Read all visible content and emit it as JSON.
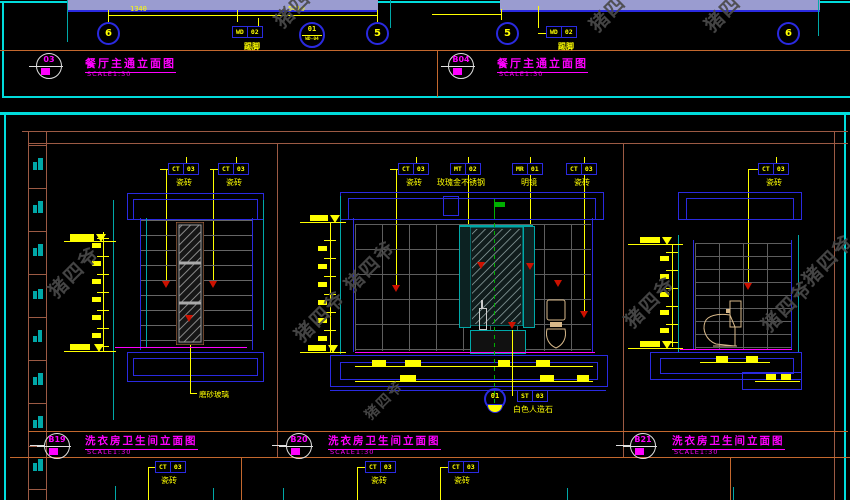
{
  "watermark": "猪四爷",
  "colors": {
    "background": "#000000",
    "viewport_border": "#00dcdc",
    "frame_orange": "#c4682e",
    "table_brown": "#9c5a44",
    "entity_blue": "#2a2ae0",
    "annotation_yellow": "#ffff00",
    "title_magenta": "#ff00ff",
    "tile_gray": "#5e5e5e",
    "frame_teal": "#00a8a8",
    "arrow_red": "#cc1100",
    "fixture_tan": "#d8b98a",
    "slab_lavender": "#9a9cd0",
    "centerline_green": "#00b000"
  },
  "top": {
    "left": {
      "bubble_l": "6",
      "bubble_r": "5",
      "dim1": "1340",
      "dim2": "5410",
      "tag": {
        "c": "WD",
        "n": "02"
      },
      "tag_label": "踢脚",
      "detail": {
        "top": "01",
        "bot": "WD-04"
      },
      "title": {
        "no": "03",
        "text": "餐厅主通立面图",
        "scale": "SCALE1:30"
      }
    },
    "right": {
      "bubble_l": "5",
      "bubble_r": "6",
      "tag": {
        "c": "WD",
        "n": "02"
      },
      "tag_label": "踢脚",
      "title": {
        "no": "B04",
        "text": "餐厅主通立面图",
        "scale": "SCALE1:30"
      }
    }
  },
  "elev_a": {
    "tag1": {
      "c": "CT",
      "n": "03"
    },
    "tag1_label": "瓷砖",
    "tag2": {
      "c": "CT",
      "n": "03"
    },
    "tag2_label": "瓷砖",
    "note": "磨砂玻璃",
    "title": {
      "no": "B19",
      "text": "洗衣房卫生间立面图",
      "scale": "SCALE1:30"
    }
  },
  "elev_b": {
    "tags": [
      {
        "c": "CT",
        "n": "03",
        "label": "瓷砖"
      },
      {
        "c": "MT",
        "n": "02",
        "label": "玫瑰金不锈钢"
      },
      {
        "c": "MR",
        "n": "01",
        "label": "明镜"
      },
      {
        "c": "CT",
        "n": "03",
        "label": "瓷砖"
      }
    ],
    "fixture": {
      "c": "ST",
      "n": "03",
      "label": "白色人造石"
    },
    "basin_no": "01",
    "title": {
      "no": "B20",
      "text": "洗衣房卫生间立面图",
      "scale": "SCALE1:30"
    }
  },
  "elev_c": {
    "tag": {
      "c": "CT",
      "n": "03",
      "label": "瓷砖"
    },
    "title": {
      "no": "B21",
      "text": "洗衣房卫生间立面图",
      "scale": "SCALE1:30"
    }
  },
  "bottom_row": {
    "tags": [
      {
        "c": "CT",
        "n": "03",
        "label": "瓷砖"
      },
      {
        "c": "CT",
        "n": "03",
        "label": "瓷砖"
      },
      {
        "c": "CT",
        "n": "03",
        "label": "瓷砖"
      }
    ]
  }
}
